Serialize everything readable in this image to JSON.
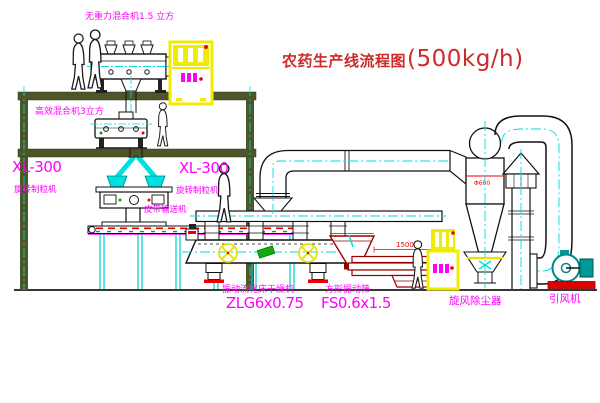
{
  "title": {
    "text": "农药生产线流程图",
    "capacity": "(500kg/h)"
  },
  "equipment": {
    "gravity_free_mixer": {
      "label": "无重力混合机1.5 立方"
    },
    "high_efficiency_mixer": {
      "label": "高效混合机3立方"
    },
    "granulator_left": {
      "model": "XL-300",
      "name": "旋转制粒机"
    },
    "granulator_right": {
      "model": "XL-300",
      "name": "旋转制粒机"
    },
    "belt_conveyor": {
      "label": "皮带输送机"
    },
    "fluid_bed_dryer": {
      "name": "振动流化床干燥机",
      "model": "ZLG6x0.75"
    },
    "vibrating_screen": {
      "name": "方形振动筛",
      "model": "FS0.6x1.5",
      "dim_width": "1500",
      "dim_height": "350"
    },
    "cyclone_dust_collector": {
      "label": "旋风除尘器",
      "dim": "Φ600"
    },
    "induced_draft_fan": {
      "label": "引风机"
    }
  },
  "colors": {
    "label_magenta": "#ff00ff",
    "title_red": "#cd2a2a",
    "centerline_cyan": "#00dddd",
    "structure_olive": "#4e5526",
    "cabinet_yellow": "#f0ec00",
    "dimension_red": "#ee0000",
    "screen_dark_red": "#990000",
    "fan_teal": "#009999",
    "conveyor_green": "#00aa00"
  }
}
